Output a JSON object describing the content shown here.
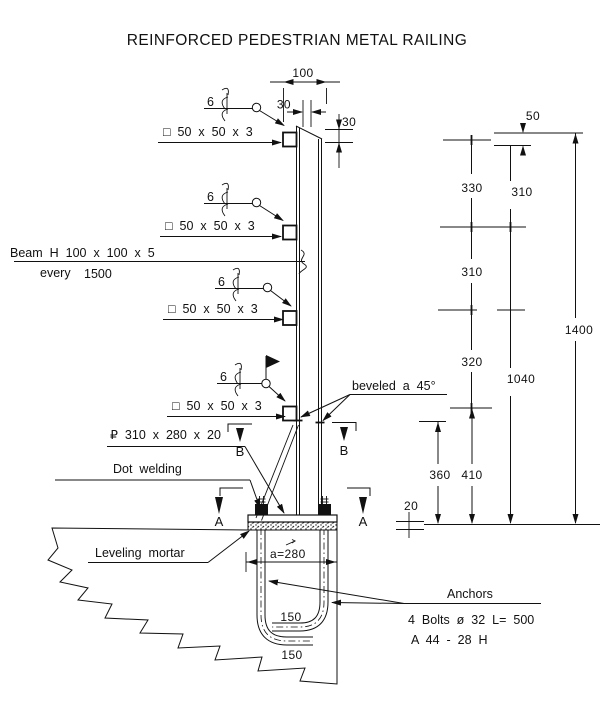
{
  "title": "REINFORCED PEDESTRIAN METAL RAILING",
  "callouts": {
    "beam_line1": "Beam H 100 x 100 x 5",
    "beam_every": "every",
    "beam_spacing": "1500",
    "rail_section": "□ 50 x 50 x 3",
    "weld_size": "6",
    "plate": "₽ 310 x 280 x 20",
    "dot_welding": "Dot welding",
    "beveled": "beveled a 45°",
    "leveling_mortar": "Leveling mortar",
    "anchors": "Anchors",
    "bolts_spec": "4 Bolts ø 32 L= 500",
    "bolts_ref": "A 44 - 28 H"
  },
  "dimensions": {
    "top_width": "100",
    "rail_offset": "30",
    "cap_bevel": "30",
    "cap": "50",
    "gap1": "330",
    "gap2": "310",
    "gap3": "320",
    "upper": "310",
    "lower": "1040",
    "total": "1400",
    "base_to_rail": "410",
    "embed_clear": "360",
    "mortar": "20",
    "bolt_spacing": "a=280",
    "hook1": "150",
    "hook2": "150"
  },
  "sections": {
    "a": "A",
    "b": "B"
  }
}
